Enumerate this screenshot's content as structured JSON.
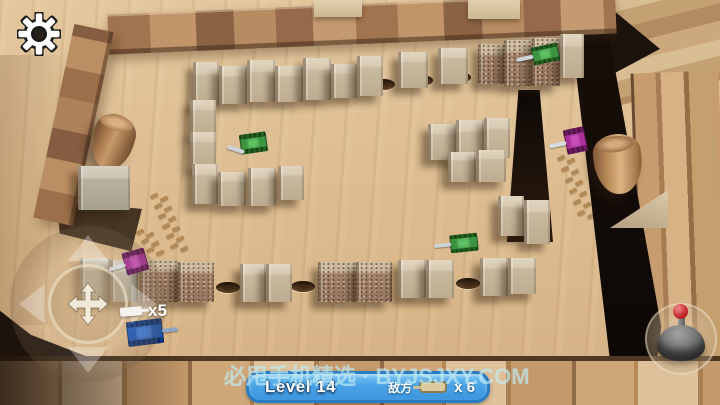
{
  "hud": {
    "settings": {
      "icon": "gear-icon"
    },
    "lives": {
      "label": "x5",
      "icon": "player-tank-icon"
    },
    "banner": {
      "level": "Level 14",
      "enemy_label": "敌方",
      "enemy_count": "x 6",
      "icon": "enemy-tank-icon",
      "bg_color": "#4aa3e6",
      "border_color": "#2a7cc2"
    },
    "watermark": "必甩手机精选 · BYJSJXY.COM",
    "controls": {
      "dpad_icon": "move-cross-icon",
      "fire_icon": "joystick-icon"
    }
  },
  "scene": {
    "colors": {
      "green": {
        "hull": "#3a9440",
        "tread": "#22601f",
        "turret": "#5ec162",
        "barrel": "#cdd3d8"
      },
      "purple": {
        "hull": "#ab2f98",
        "tread": "#6e1a62",
        "turret": "#cb4fbb",
        "barrel": "#d8dde2"
      },
      "blue": {
        "hull": "#1c55b4",
        "tread": "#10387e",
        "turret": "#3b77d8",
        "barrel": "#8fa6c4"
      }
    },
    "tanks": [
      {
        "name": "enemy-tank-green-top",
        "color": "green",
        "x": 532,
        "y": 46,
        "w": 27,
        "h": 16,
        "rot": -12,
        "barrel": "left"
      },
      {
        "name": "enemy-tank-green-left",
        "color": "green",
        "x": 240,
        "y": 134,
        "w": 27,
        "h": 18,
        "rot": -8,
        "barrel": "down-left"
      },
      {
        "name": "enemy-tank-green-center",
        "color": "green",
        "x": 450,
        "y": 235,
        "w": 28,
        "h": 16,
        "rot": -6,
        "barrel": "left"
      },
      {
        "name": "enemy-tank-purple-right",
        "color": "purple",
        "x": 565,
        "y": 129,
        "w": 21,
        "h": 23,
        "rot": -12,
        "barrel": "left"
      },
      {
        "name": "enemy-tank-purple-bottom",
        "color": "purple",
        "x": 124,
        "y": 251,
        "w": 23,
        "h": 21,
        "rot": -16,
        "barrel": "left"
      },
      {
        "name": "player-tank-blue",
        "color": "blue",
        "x": 127,
        "y": 321,
        "w": 36,
        "h": 23,
        "rot": -7,
        "barrel": "right"
      }
    ],
    "blocks": [
      {
        "x": 193,
        "y": 62,
        "w": 26,
        "h": 44
      },
      {
        "x": 219,
        "y": 66,
        "w": 28,
        "h": 38
      },
      {
        "x": 247,
        "y": 60,
        "w": 28,
        "h": 42
      },
      {
        "x": 275,
        "y": 66,
        "w": 28,
        "h": 36
      },
      {
        "x": 303,
        "y": 58,
        "w": 28,
        "h": 42
      },
      {
        "x": 331,
        "y": 64,
        "w": 26,
        "h": 34
      },
      {
        "x": 357,
        "y": 56,
        "w": 26,
        "h": 40
      },
      {
        "x": 398,
        "y": 52,
        "w": 30,
        "h": 36
      },
      {
        "x": 438,
        "y": 48,
        "w": 30,
        "h": 36
      },
      {
        "x": 478,
        "y": 44,
        "w": 26,
        "h": 40,
        "t": "brick"
      },
      {
        "x": 504,
        "y": 40,
        "w": 28,
        "h": 46,
        "t": "brick"
      },
      {
        "x": 532,
        "y": 38,
        "w": 28,
        "h": 48,
        "t": "brick"
      },
      {
        "x": 560,
        "y": 34,
        "w": 24,
        "h": 44
      },
      {
        "x": 190,
        "y": 100,
        "w": 26,
        "h": 36
      },
      {
        "x": 190,
        "y": 132,
        "w": 26,
        "h": 36
      },
      {
        "x": 192,
        "y": 164,
        "w": 26,
        "h": 40
      },
      {
        "x": 218,
        "y": 172,
        "w": 28,
        "h": 34
      },
      {
        "x": 248,
        "y": 168,
        "w": 28,
        "h": 38
      },
      {
        "x": 278,
        "y": 166,
        "w": 26,
        "h": 34
      },
      {
        "x": 428,
        "y": 124,
        "w": 28,
        "h": 36
      },
      {
        "x": 456,
        "y": 120,
        "w": 28,
        "h": 42
      },
      {
        "x": 484,
        "y": 118,
        "w": 26,
        "h": 40
      },
      {
        "x": 448,
        "y": 152,
        "w": 28,
        "h": 30
      },
      {
        "x": 476,
        "y": 150,
        "w": 30,
        "h": 32
      },
      {
        "x": 498,
        "y": 196,
        "w": 26,
        "h": 40
      },
      {
        "x": 524,
        "y": 200,
        "w": 26,
        "h": 44
      },
      {
        "x": 78,
        "y": 166,
        "w": 52,
        "h": 44,
        "t": "gray"
      },
      {
        "x": 80,
        "y": 258,
        "w": 30,
        "h": 44,
        "t": "gray"
      },
      {
        "x": 110,
        "y": 260,
        "w": 28,
        "h": 42,
        "t": "gray"
      },
      {
        "x": 140,
        "y": 260,
        "w": 38,
        "h": 42,
        "t": "brick"
      },
      {
        "x": 178,
        "y": 262,
        "w": 36,
        "h": 40,
        "t": "brick"
      },
      {
        "x": 240,
        "y": 264,
        "w": 26,
        "h": 38
      },
      {
        "x": 266,
        "y": 264,
        "w": 26,
        "h": 38
      },
      {
        "x": 318,
        "y": 262,
        "w": 38,
        "h": 40,
        "t": "brick"
      },
      {
        "x": 356,
        "y": 262,
        "w": 36,
        "h": 40,
        "t": "brick"
      },
      {
        "x": 398,
        "y": 260,
        "w": 28,
        "h": 38
      },
      {
        "x": 426,
        "y": 260,
        "w": 28,
        "h": 38
      },
      {
        "x": 480,
        "y": 258,
        "w": 28,
        "h": 38
      },
      {
        "x": 508,
        "y": 258,
        "w": 28,
        "h": 36
      }
    ],
    "holes": [
      [
        383,
        84
      ],
      [
        421,
        80
      ],
      [
        459,
        77
      ],
      [
        228,
        287
      ],
      [
        303,
        286
      ],
      [
        468,
        283
      ]
    ],
    "trails": [
      {
        "x": 150,
        "y": 194,
        "dx": 4,
        "dy": 10,
        "n": 6
      },
      {
        "x": 557,
        "y": 156,
        "dx": 4,
        "dy": 11,
        "n": 6
      },
      {
        "x": 136,
        "y": 230,
        "dx": 5,
        "dy": 9,
        "n": 3
      }
    ]
  }
}
